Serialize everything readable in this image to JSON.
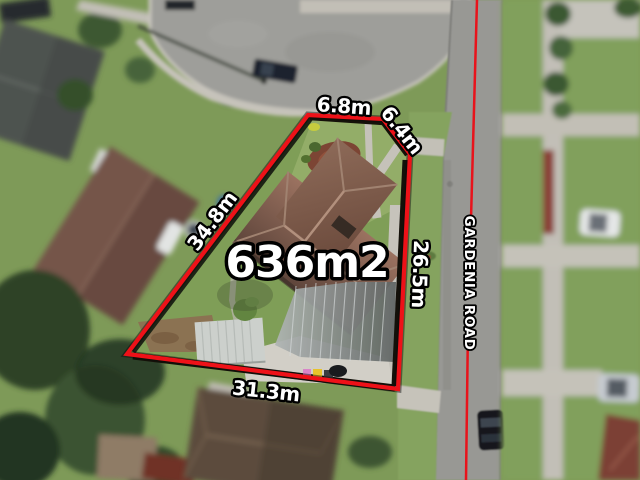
{
  "scene": {
    "area_label": "636m2",
    "dimensions": {
      "front": "6.8m",
      "splay": "6.4m",
      "left": "34.8m",
      "right": "26.5m",
      "rear": "31.3m"
    },
    "road": {
      "name": "GARDENIA ROAD"
    },
    "colors": {
      "boundary_red": "#ee1118",
      "centerline_red": "#e8131b",
      "label_fill": "#ffffff",
      "label_outline": "#000000"
    }
  }
}
